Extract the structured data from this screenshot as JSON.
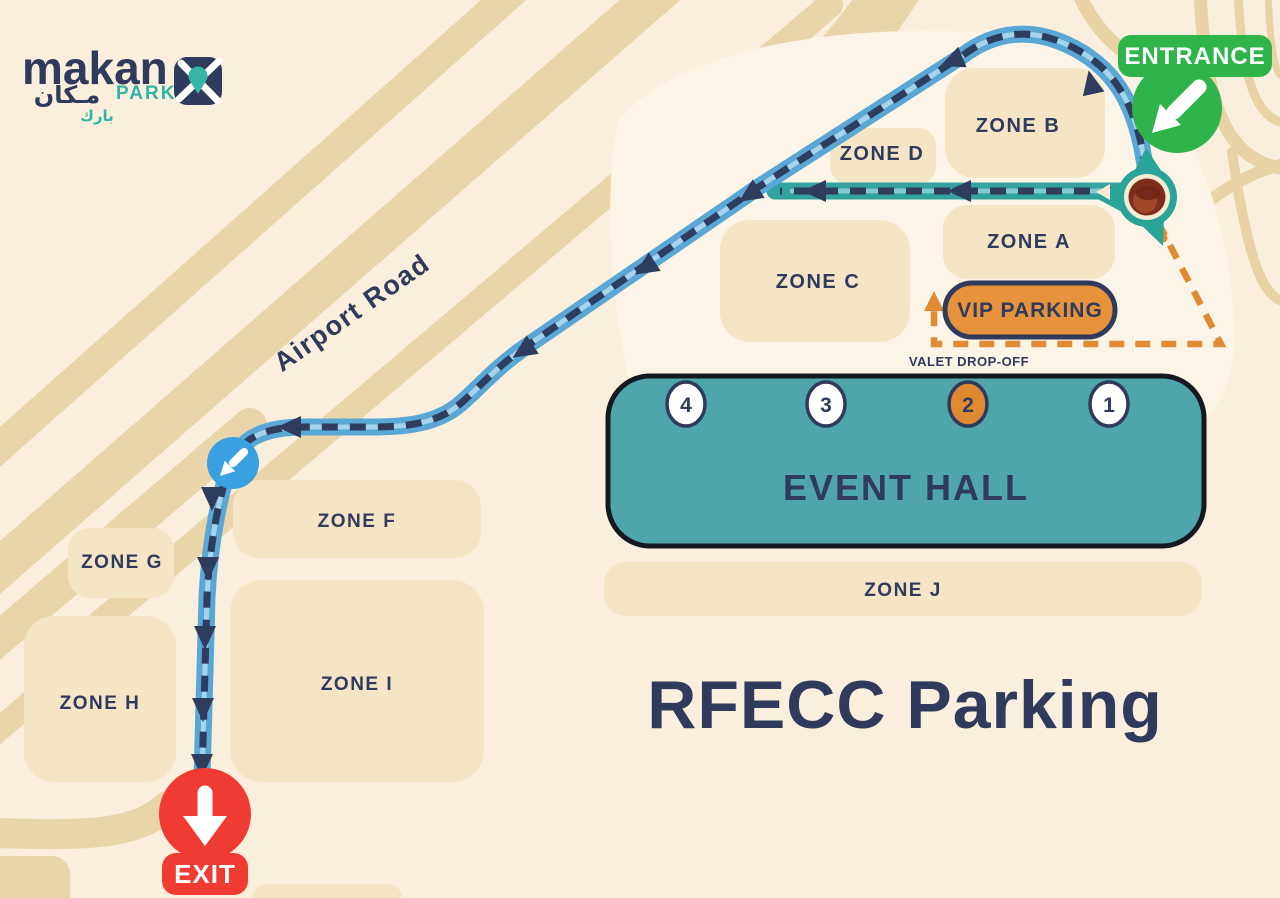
{
  "title": "RFECC Parking",
  "logo": {
    "brand": "makan",
    "brand_arabic": "مـكان",
    "park": "PARK",
    "park_arabic": "بارك"
  },
  "labels": {
    "entrance": "ENTRANCE",
    "exit": "EXIT",
    "airport_road": "Airport Road",
    "vip_parking": "VIP PARKING",
    "valet_dropoff": "VALET DROP-OFF",
    "event_hall": "EVENT HALL"
  },
  "zones": [
    {
      "id": "B",
      "label": "ZONE B"
    },
    {
      "id": "D",
      "label": "ZONE D"
    },
    {
      "id": "A",
      "label": "ZONE A"
    },
    {
      "id": "C",
      "label": "ZONE C"
    },
    {
      "id": "F",
      "label": "ZONE F"
    },
    {
      "id": "G",
      "label": "ZONE G"
    },
    {
      "id": "H",
      "label": "ZONE H"
    },
    {
      "id": "I",
      "label": "ZONE I"
    },
    {
      "id": "J",
      "label": "ZONE J"
    }
  ],
  "gates": [
    {
      "number": "4",
      "highlighted": false
    },
    {
      "number": "3",
      "highlighted": false
    },
    {
      "number": "2",
      "highlighted": true
    },
    {
      "number": "1",
      "highlighted": false
    }
  ],
  "colors": {
    "background": "#FAEFDC",
    "tan_road": "#EAD5AB",
    "zone_block": "#F4E5C5",
    "navy_text": "#2F3A5C",
    "route_dash": "#2E3C5E",
    "blue_road": "#58A7D4",
    "teal_road": "#33A3A0",
    "event_hall": "#4FA5AC",
    "vip_orange": "#E6933C",
    "valet_orange": "#E08A33",
    "entrance_green": "#2EB44B",
    "exit_red": "#F03B33",
    "marker_blue": "#3AA1E0",
    "roundabout_teal": "#2AA398",
    "roundabout_maroon": "#7E2D1D",
    "brand_teal": "#2FB5A8"
  }
}
